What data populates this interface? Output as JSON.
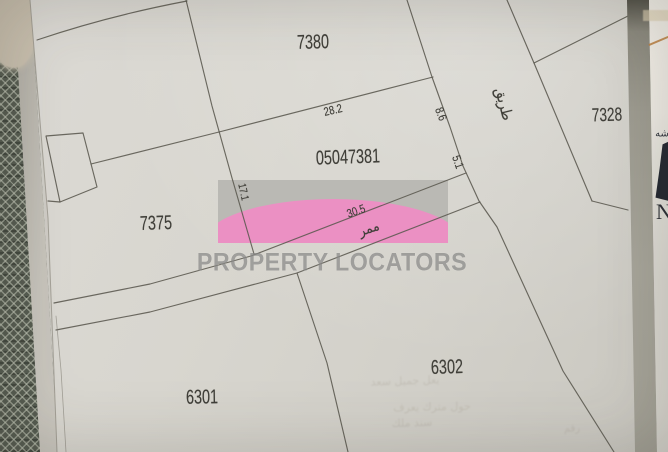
{
  "map": {
    "plots": {
      "top": "7380",
      "right": "7328",
      "center": "05047381",
      "west": "7375",
      "bottom_left": "6301",
      "bottom_right": "6302"
    },
    "measurements": {
      "top_boundary": "28.2",
      "road_upper": "8.6",
      "road_lower": "5.1",
      "west_boundary": "17.1",
      "passage": "30.5"
    },
    "annotations": {
      "road_ar": "طريق",
      "passage_ar": "ممر"
    }
  },
  "watermark": {
    "brand": "PROPERTY LOCATORS",
    "pink": "#ee87c2",
    "gray": "#b3b2ae"
  },
  "edge_items": {
    "arabic_glyphs": "شه",
    "letter": "N"
  },
  "bleed_through": {
    "line1": "يعل جميل سعد",
    "line2": "حول مترك يعرف",
    "line3": "سند ملك",
    "line4": "رقم"
  },
  "colors": {
    "paper": "#d6d4cd",
    "ink": "#403f39",
    "boundary_line": "#5a584f",
    "fabric": "#565c51",
    "accent_orange": "#bd8040",
    "navy": "#242832"
  }
}
